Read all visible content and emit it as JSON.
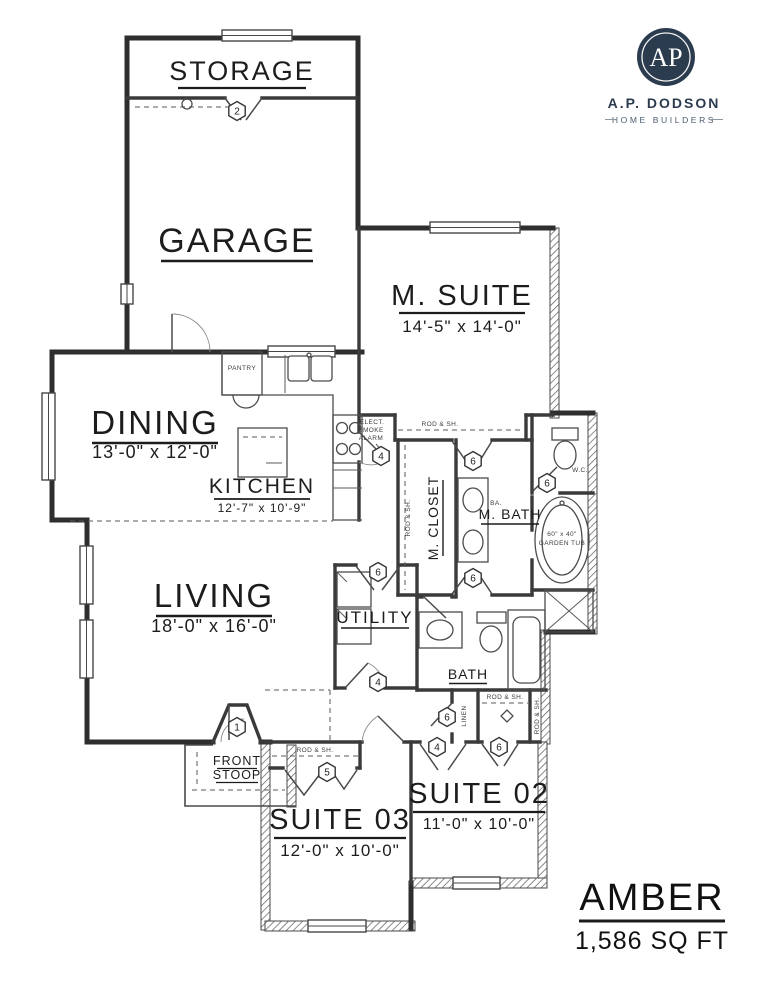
{
  "logo": {
    "monogram": "AP",
    "company": "A.P. DODSON",
    "tagline": "HOME BUILDERS"
  },
  "plan": {
    "name": "AMBER",
    "area": "1,586 SQ FT"
  },
  "rooms": {
    "storage": {
      "label": "STORAGE"
    },
    "garage": {
      "label": "GARAGE"
    },
    "m_suite": {
      "label": "M. SUITE",
      "dims": "14'-5\" x 14'-0\""
    },
    "dining": {
      "label": "DINING",
      "dims": "13'-0\" x 12'-0\""
    },
    "kitchen": {
      "label": "KITCHEN",
      "dims": "12'-7\" x 10'-9\""
    },
    "living": {
      "label": "LIVING",
      "dims": "18'-0\" x 16'-0\""
    },
    "utility": {
      "label": "UTILITY"
    },
    "m_closet": {
      "label": "M. CLOSET"
    },
    "m_bath": {
      "label": "M. BATH"
    },
    "bath": {
      "label": "BATH"
    },
    "front_stoop": {
      "line1": "FRONT",
      "line2": "STOOP"
    },
    "suite03": {
      "label": "SUITE 03",
      "dims": "12'-0\" x 10'-0\""
    },
    "suite02": {
      "label": "SUITE 02",
      "dims": "11'-0\" x 10'-0\""
    }
  },
  "annotations": {
    "pantry": "PANTRY",
    "rod_and_shelf": "ROD & SH.",
    "linen": "LINEN",
    "water_closet": "W.C.",
    "ba": "BA.",
    "garden_tub_size": "60\" x 40\"",
    "garden_tub_name": "GARDEN TUB",
    "smoke_alarm_line1": "ELECT.",
    "smoke_alarm_line2": "SMOKE",
    "smoke_alarm_line3": "ALARM"
  },
  "door_markers": {
    "garage_storage": "2",
    "kitchen_hall": "4",
    "m_suite_entry": "6",
    "wc_door": "6",
    "m_closet_door": "6",
    "utility_door": "6",
    "utility_hall_door": "4",
    "linen_door": "6",
    "front_door": "1",
    "suite03_closet": "5",
    "suite02_entry": "4",
    "suite02_closet": "6"
  },
  "colors": {
    "ink": "#1c1c1c",
    "wall": "#2e2e2e",
    "logo_navy": "#2b3c4f",
    "tagline_gray": "#4c5b6b"
  }
}
